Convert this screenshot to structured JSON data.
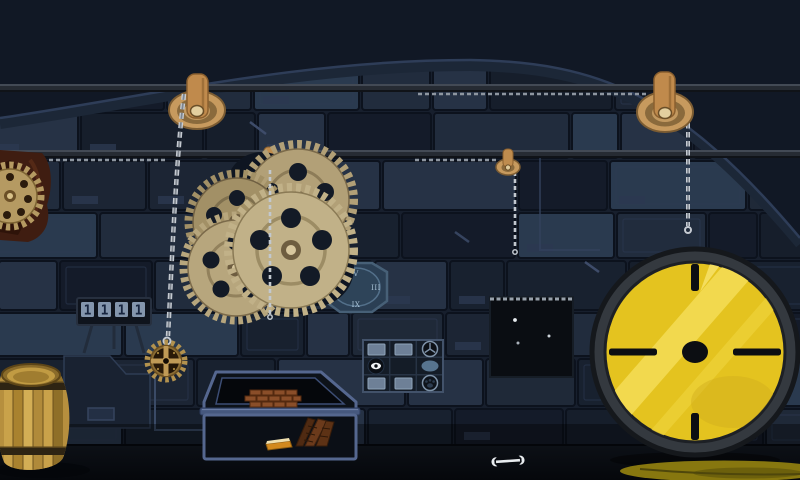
{
  "scene": {
    "type": "escape-room-game-scene",
    "description": "Dark mechanical wall room with gears, pulleys, chains and puzzle devices",
    "background_color": "#111825",
    "wall_color": "#1c2534",
    "accent_yellow": "#e4c31f",
    "bronze": "#c0945a"
  },
  "counter_display": {
    "value": "1111",
    "digits": [
      "1",
      "1",
      "1",
      "1"
    ],
    "tile_color": "#8496ad"
  },
  "octagon_clock": {
    "numerals": {
      "top": "V",
      "right": "III",
      "bottom": "IX",
      "left": "VI"
    }
  },
  "symbol_grid": {
    "rows": 3,
    "cols": 3,
    "cells": [
      [
        "tile",
        "tile",
        "wheel"
      ],
      [
        "eye",
        "empty",
        "oval"
      ],
      [
        "tile",
        "tile",
        "paw"
      ]
    ]
  },
  "star_box": {
    "dot_count": 3,
    "dots": [
      {
        "x": 515,
        "y": 320
      },
      {
        "x": 549,
        "y": 336
      },
      {
        "x": 518,
        "y": 343
      }
    ]
  },
  "dial_wheel": {
    "face_color": "#e4c31f",
    "tick_positions": [
      "top",
      "right",
      "bottom",
      "left"
    ]
  },
  "objects": {
    "pulley_count": 4,
    "rail_count": 2,
    "gear_cluster_count": 4,
    "hanging_gear_pendant": 1,
    "barrel": 1,
    "shelf_books": 3,
    "flat_book": 1,
    "wrench": 1
  }
}
